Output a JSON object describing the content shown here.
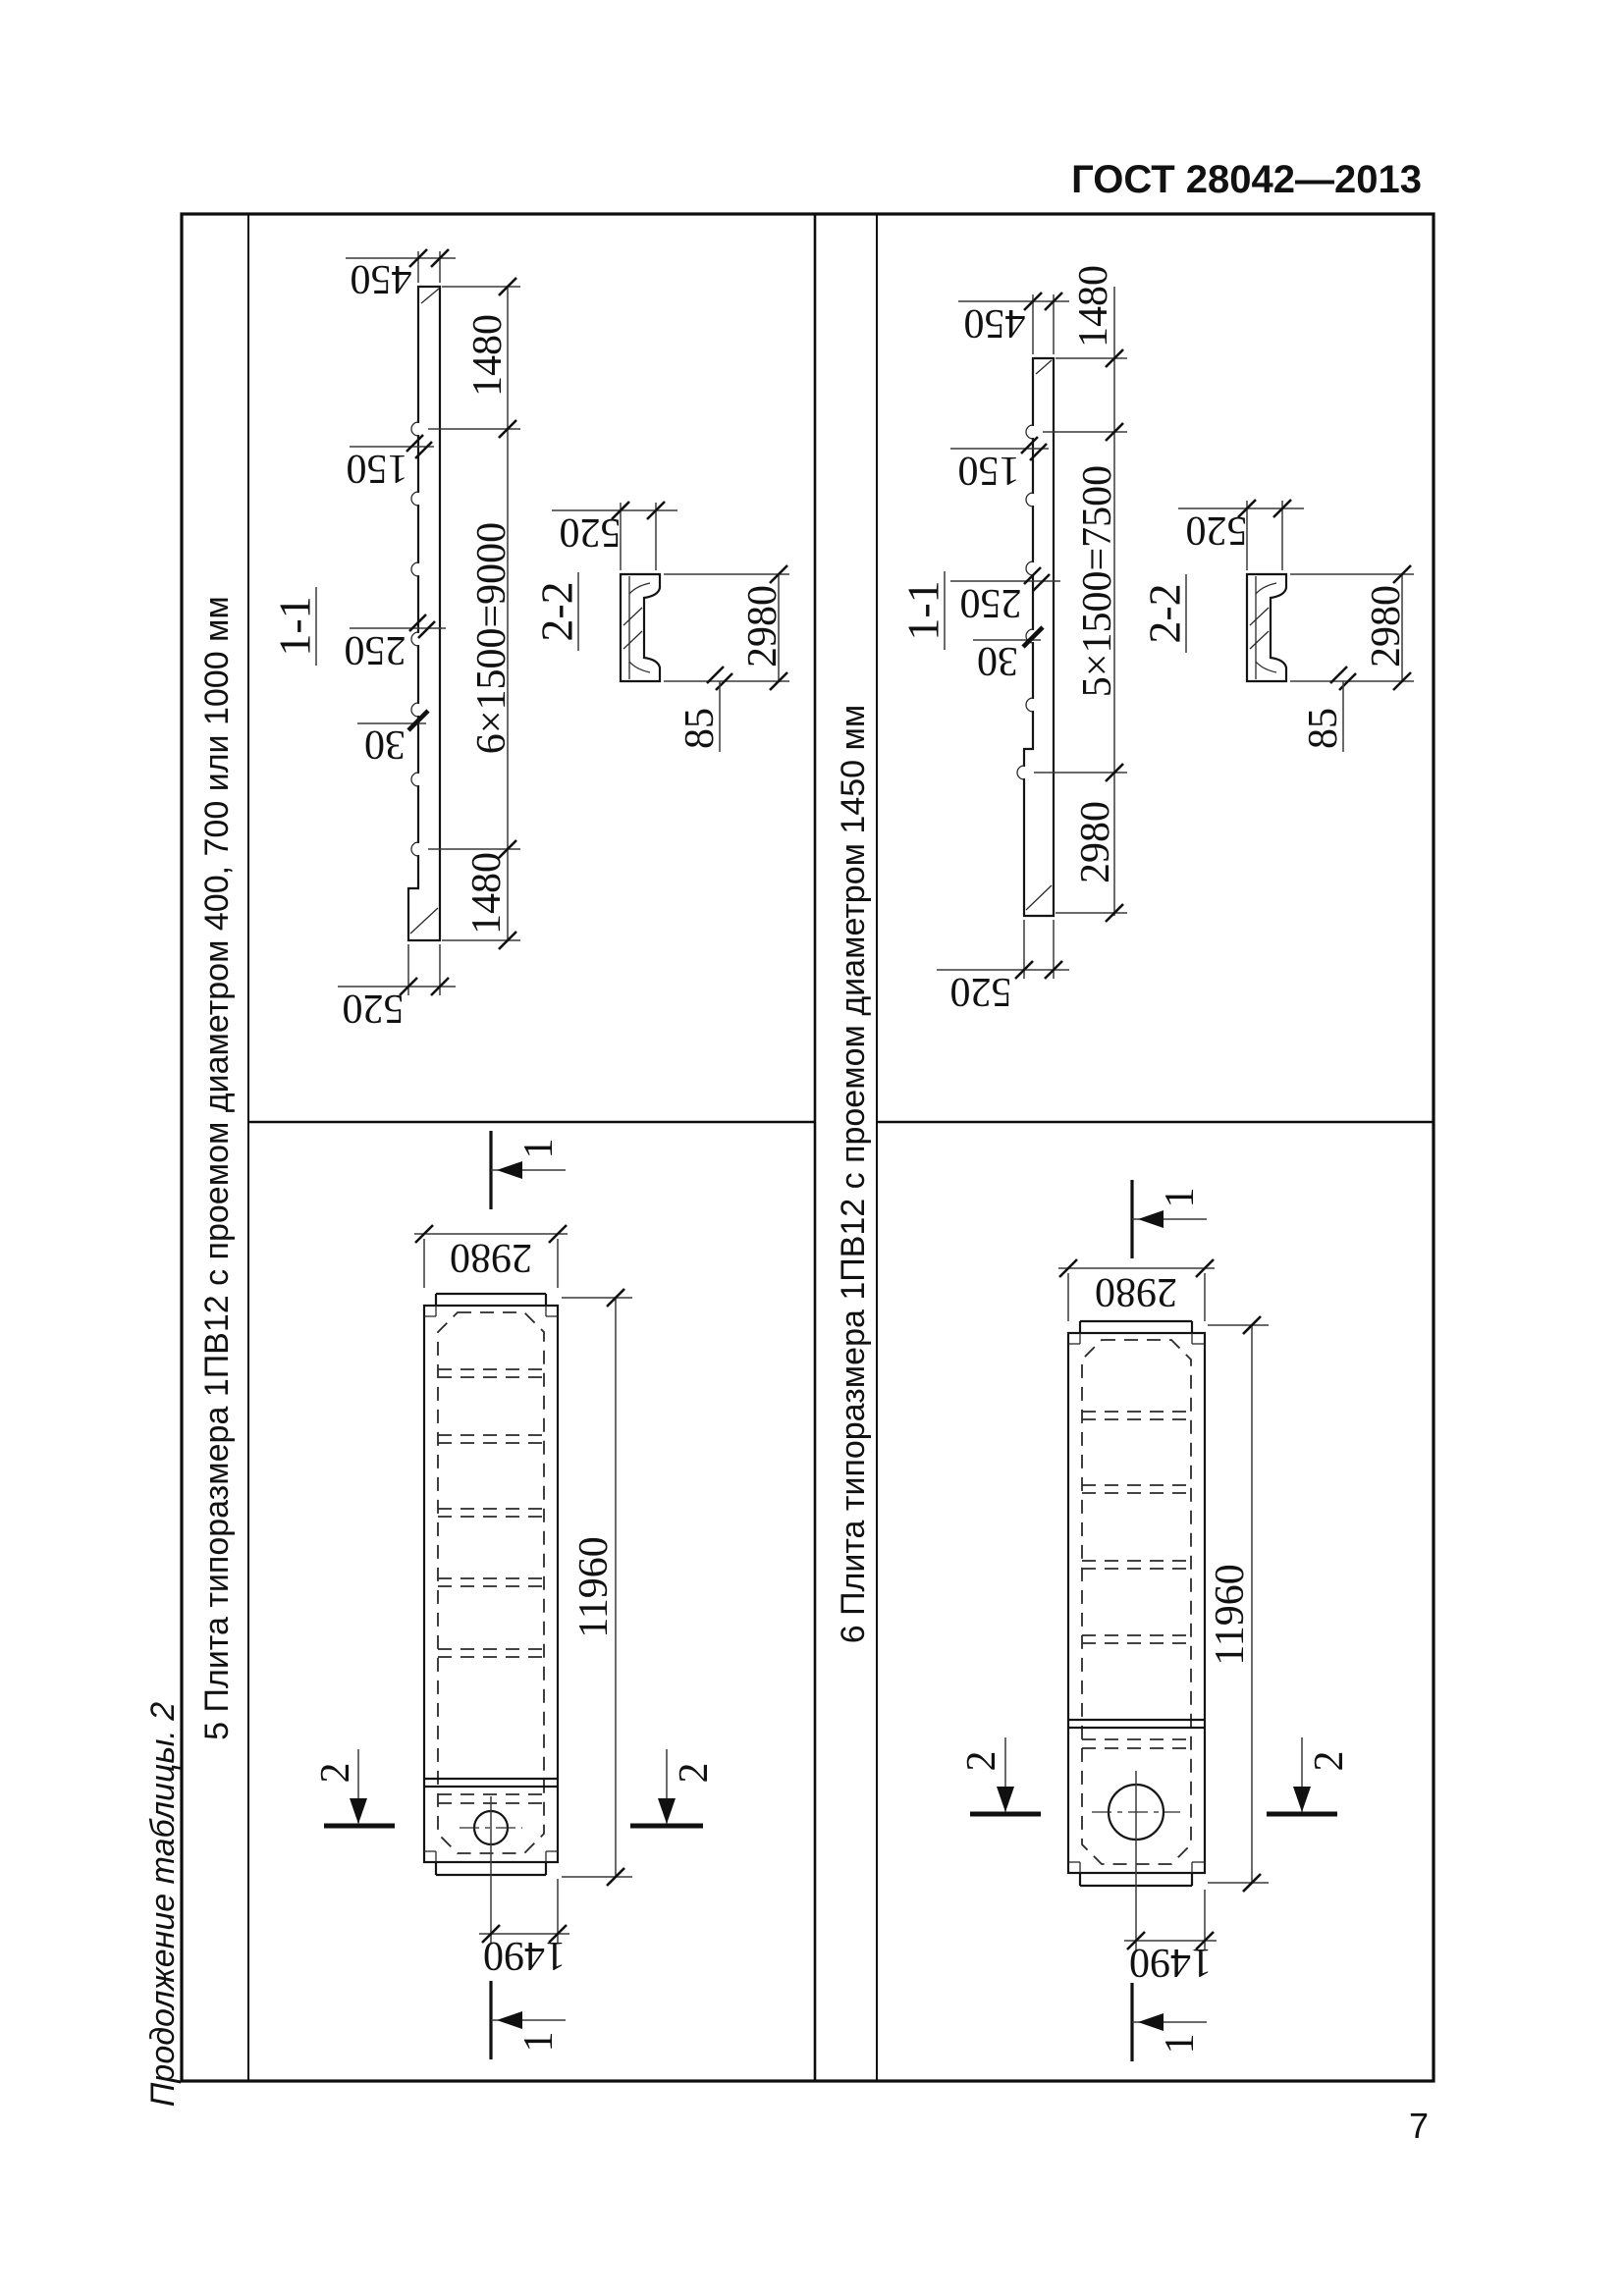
{
  "page": {
    "header": "ГОСТ 28042—2013",
    "continuation_label": "Продолжение таблицы. 2",
    "page_number": "7"
  },
  "panel5": {
    "title": "5 Плита типоразмера 1ПВ12 с проемом диаметром 400, 700 или 1000 мм",
    "section11": {
      "label": "1-1",
      "d450": "450",
      "d150": "150",
      "d250": "250",
      "d30": "30",
      "d1480_top": "1480",
      "series": "6×1500=9000",
      "d1480_bottom": "1480",
      "d520": "520"
    },
    "section22": {
      "label": "2-2",
      "d520": "520",
      "d2980": "2980",
      "d85": "85"
    },
    "plan": {
      "width": "2980",
      "length": "11960",
      "hole_offset": "1490",
      "cut1": "1",
      "cut2": "2"
    }
  },
  "panel6": {
    "title": "6 Плита типоразмера 1ПВ12 с проемом диаметром 1450 мм",
    "section11": {
      "label": "1-1",
      "d450": "450",
      "d150": "150",
      "d250": "250",
      "d30": "30",
      "d1480_top": "1480",
      "series": "5×1500=7500",
      "d2980": "2980",
      "d520": "520"
    },
    "section22": {
      "label": "2-2",
      "d520": "520",
      "d2980": "2980",
      "d85": "85"
    },
    "plan": {
      "width": "2980",
      "length": "11960",
      "hole_offset": "1490",
      "cut1": "1",
      "cut2": "2"
    }
  }
}
